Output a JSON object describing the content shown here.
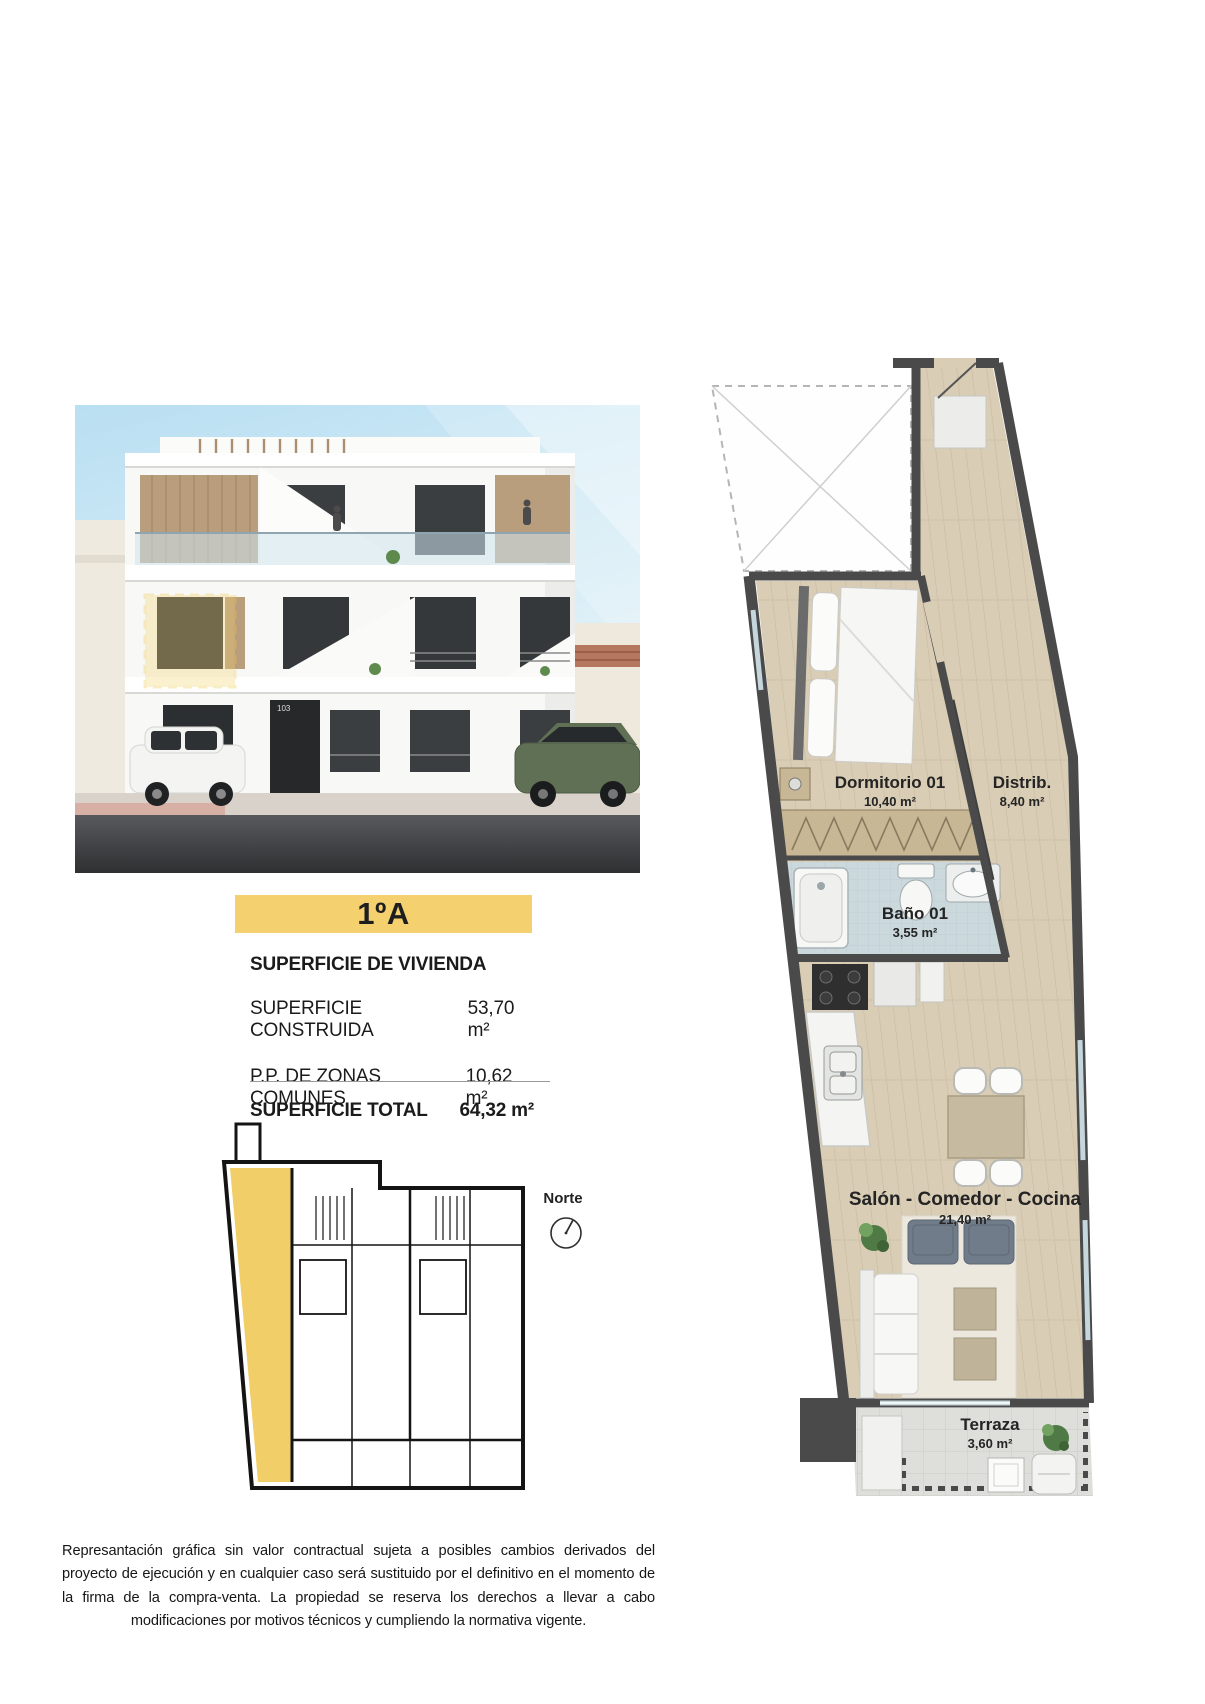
{
  "header": {
    "unit_label": "1ºA"
  },
  "building_render": {
    "building_number": "103"
  },
  "surface_table": {
    "title": "SUPERFICIE DE VIVIENDA",
    "rows": [
      {
        "label": "SUPERFICIE CONSTRUIDA",
        "value": "53,70 m²"
      },
      {
        "label": "P.P. DE ZONAS COMUNES",
        "value": "10,62 m²"
      }
    ],
    "total_label": "SUPERFICIE TOTAL",
    "total_value": "64,32 m²"
  },
  "site_plan": {
    "compass_label": "Norte"
  },
  "floor_plan": {
    "rooms": [
      {
        "name": "Dormitorio 01",
        "area": "10,40 m²"
      },
      {
        "name": "Distrib.",
        "area": "8,40 m²"
      },
      {
        "name": "Baño 01",
        "area": "3,55 m²"
      },
      {
        "name": "Salón - Comedor - Cocina",
        "area": "21,40 m²"
      },
      {
        "name": "Terraza",
        "area": "3,60 m²"
      }
    ]
  },
  "footer": {
    "disclaimer": "Represantación gráfica sin valor contractual sujeta a posibles cambios derivados del proyecto de ejecución y en cualquier caso será sustituido por el definitivo en el momento de la firma de la compra-venta. La propiedad se reserva los derechos a llevar a cabo modificaciones por motivos técnicos y cumpliendo la normativa vigente."
  },
  "colors": {
    "accent_yellow": "#F5D06E",
    "plan_highlight_yellow": "#F2CE68",
    "wall_gray": "#4A4A4A",
    "wood_floor": "#D9CDB6",
    "bath_tile": "#CBD9DD",
    "terrace_tile": "#DEDEDB"
  }
}
